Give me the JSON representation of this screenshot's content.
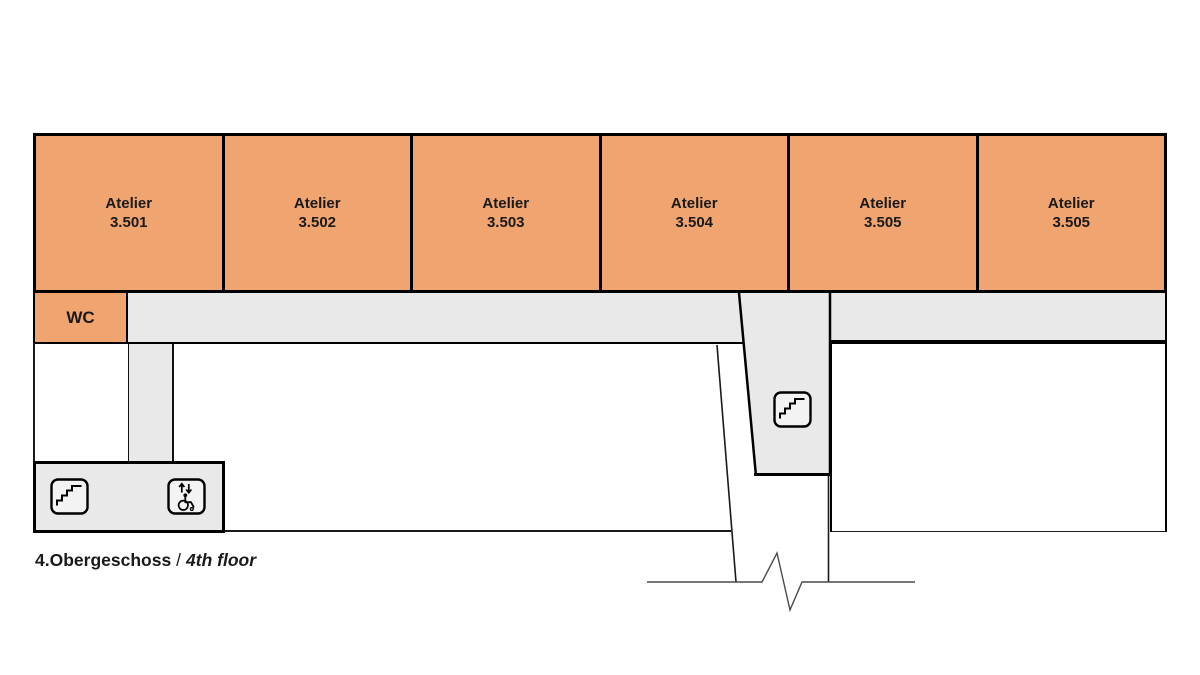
{
  "floorplan": {
    "rooms": [
      {
        "label": "Atelier",
        "number": "3.501"
      },
      {
        "label": "Atelier",
        "number": "3.502"
      },
      {
        "label": "Atelier",
        "number": "3.503"
      },
      {
        "label": "Atelier",
        "number": "3.504"
      },
      {
        "label": "Atelier",
        "number": "3.505"
      },
      {
        "label": "Atelier",
        "number": "3.505"
      }
    ],
    "wc_label": "WC",
    "caption": {
      "de": "4.Obergeschoss",
      "separator": "/",
      "en": "4th floor"
    },
    "icons": [
      {
        "name": "stairs-icon",
        "meaning": "staircase in stair room"
      },
      {
        "name": "elevator-accessible-icon",
        "meaning": "wheelchair accessible elevator"
      },
      {
        "name": "stairs-icon",
        "meaning": "staircase in central stairwell"
      }
    ],
    "colors": {
      "room_fill": "#F0A470",
      "circulation_fill": "#E9E9E9",
      "wall": "#000000",
      "text": "#1A1A1A",
      "break_line": "#4A4A4A"
    }
  }
}
